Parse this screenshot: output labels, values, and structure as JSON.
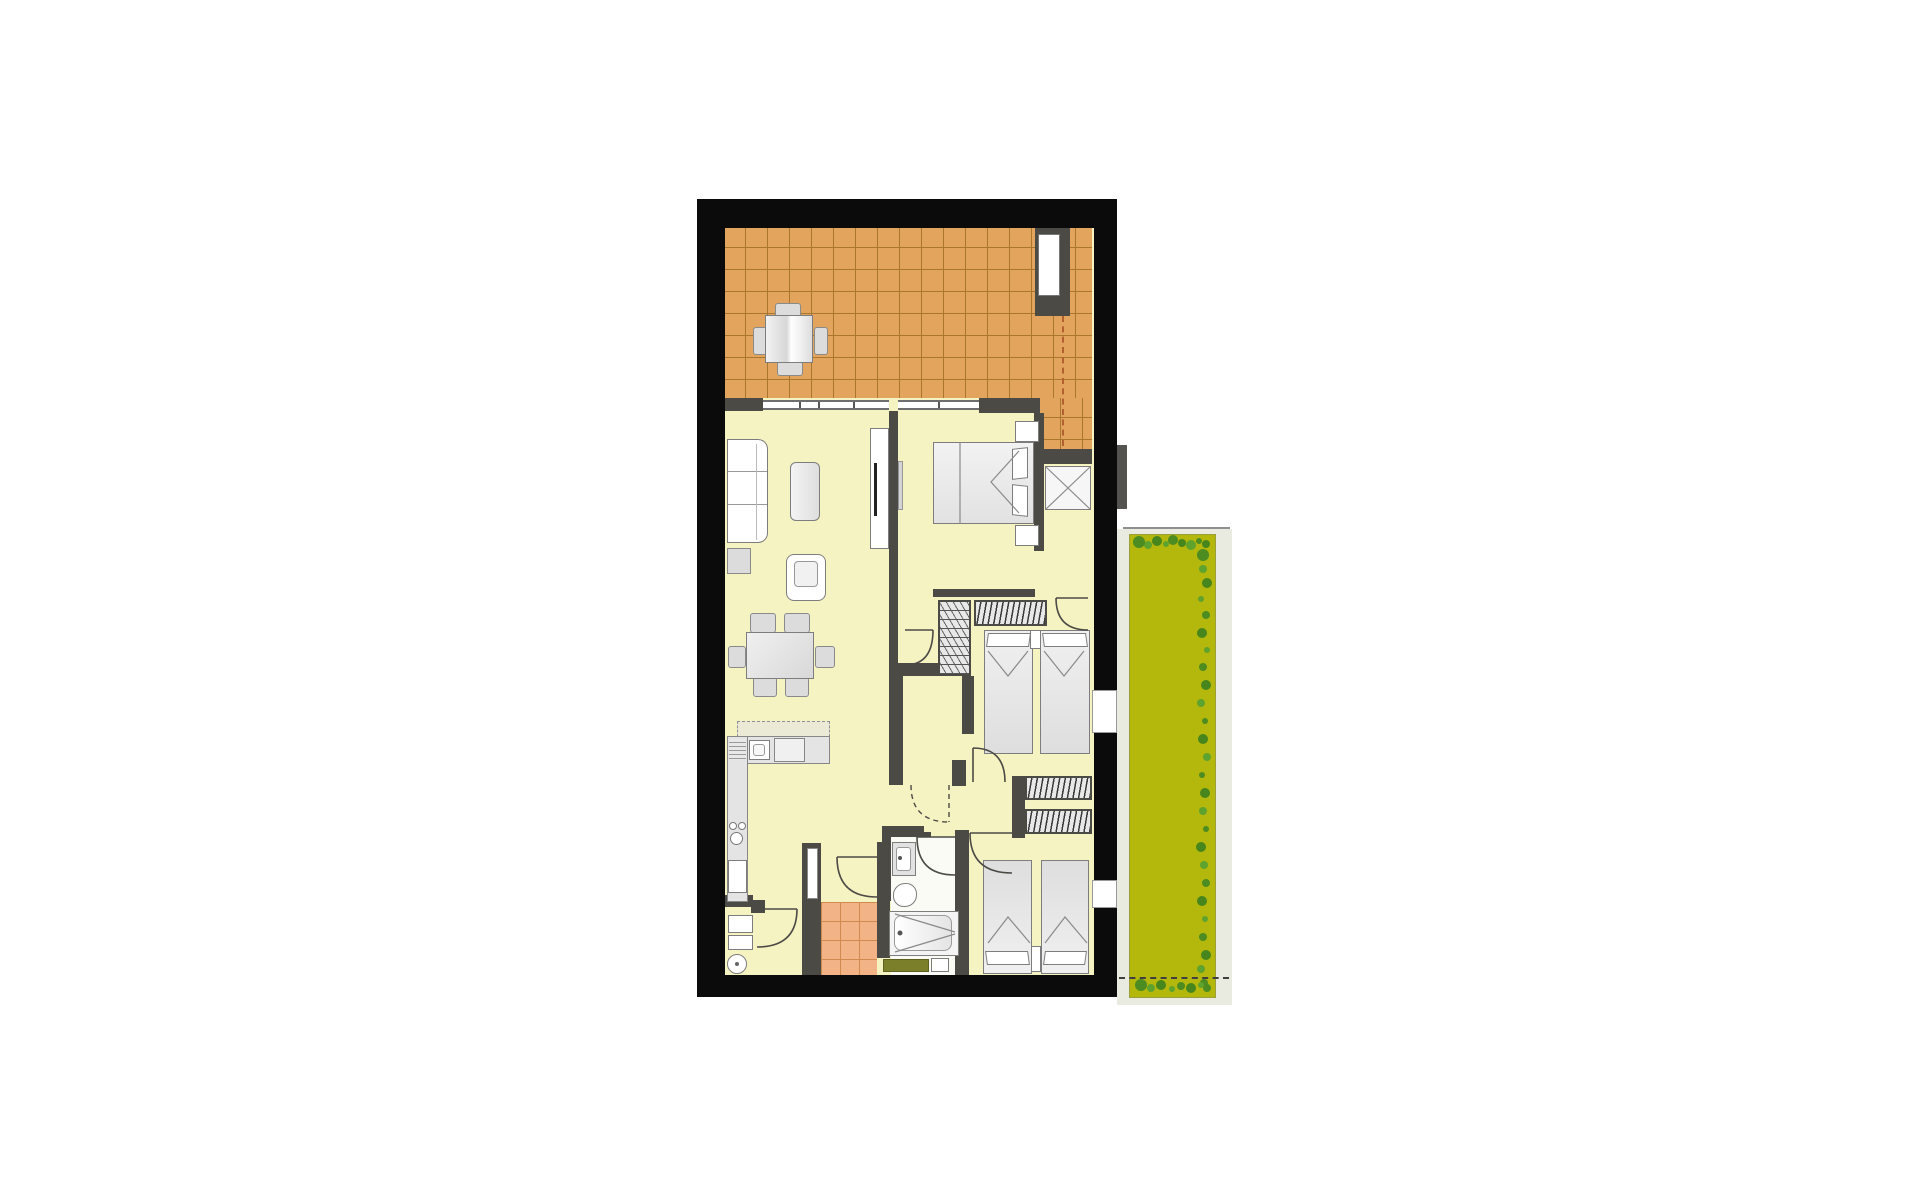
{
  "scene": {
    "kind": "apartment-floor-plan",
    "orientation": "portrait",
    "visible_text": [],
    "areas": [
      {
        "name": "terrace",
        "floor": "orange-tile",
        "furniture": [
          "square-table",
          "four-chairs",
          "duct-recess"
        ]
      },
      {
        "name": "living-dining-room",
        "floor": "pale-yellow",
        "furniture": [
          "sofa",
          "side-table",
          "coffee-table",
          "armchair",
          "tv-sideboard",
          "dining-table",
          "six-chairs"
        ]
      },
      {
        "name": "kitchen",
        "floor": "pale-yellow",
        "furniture": [
          "upper-cabinets",
          "counter",
          "sink",
          "cooker",
          "hob",
          "fridge"
        ]
      },
      {
        "name": "bedroom-1",
        "floor": "pale-yellow",
        "furniture": [
          "double-bed",
          "two-nightstands",
          "wardrobe",
          "wall-mirror"
        ]
      },
      {
        "name": "bedroom-2",
        "floor": "pale-yellow",
        "furniture": [
          "twin-bed-left",
          "twin-bed-right",
          "nightstand",
          "hanging-closet",
          "shelf-closet",
          "garden-window"
        ]
      },
      {
        "name": "bedroom-3",
        "floor": "pale-yellow",
        "furniture": [
          "twin-bed-left",
          "twin-bed-right",
          "nightstand",
          "two-hanging-closets",
          "garden-window"
        ]
      },
      {
        "name": "storage-room",
        "floor": "pale-yellow",
        "furniture": []
      },
      {
        "name": "bathroom",
        "floor": "white",
        "furniture": [
          "washbasin",
          "toilet",
          "bathtub",
          "bath-mat",
          "washer"
        ]
      },
      {
        "name": "utility-room",
        "floor": "orange-tile",
        "furniture": [
          "shelf-niche"
        ]
      },
      {
        "name": "wc-shower-room",
        "floor": "pale-yellow",
        "furniture": [
          "shower",
          "toilet"
        ]
      },
      {
        "name": "garden-strip",
        "floor": "lawn",
        "furniture": [
          "hedge-bushes",
          "boundary-dashed-line"
        ]
      }
    ],
    "door_arcs": 8,
    "windows": 4
  },
  "palette": {
    "wall-outer": "#0b0b0b",
    "wall-inner": "#4b4a45",
    "floor": "#f6f3c3",
    "terrace": "#e3a55e",
    "terrace-line": "#a8762f",
    "bathtile": "#f2b487",
    "bathtile-line": "#cf8a4e",
    "garden": "#b4b70c",
    "garden-pale": "#e9eae0",
    "bush": "#4c8c20",
    "bush2": "#5ea32d",
    "bush3": "#47851d",
    "furn-stroke": "#7d7d7d",
    "furn-fill": "#ededed",
    "gray-fill": "#dcdcdc",
    "mat": "#7c7f2a",
    "dash-red": "#b2602f"
  }
}
